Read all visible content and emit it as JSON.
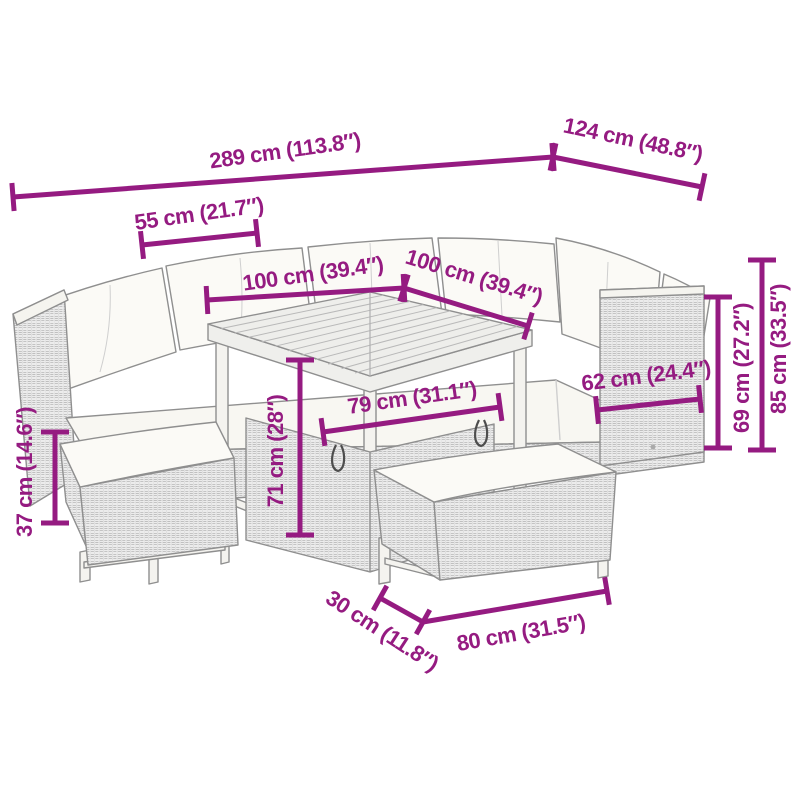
{
  "diagram": {
    "type": "furniture-dimension-diagram",
    "subject": "rattan-garden-lounge-set-with-table-and-benches",
    "accent_color": "#951b81",
    "palette": {
      "outline": "#8f8f8f",
      "wicker_fill": "#ececec",
      "wicker_weave": "#bfbfbf",
      "cushion_fill": "#fbfaf6",
      "background": "#ffffff"
    }
  },
  "dims": {
    "d289": {
      "label": "289 cm (113.8″)",
      "value_cm": 289,
      "value_in": 113.8
    },
    "d124": {
      "label": "124 cm (48.8″)",
      "value_cm": 124,
      "value_in": 48.8
    },
    "d55": {
      "label": "55 cm (21.7″)",
      "value_cm": 55,
      "value_in": 21.7
    },
    "d100a": {
      "label": "100 cm (39.4″)",
      "value_cm": 100,
      "value_in": 39.4
    },
    "d100b": {
      "label": "100 cm (39.4″)",
      "value_cm": 100,
      "value_in": 39.4
    },
    "d79": {
      "label": "79 cm (31.1″)",
      "value_cm": 79,
      "value_in": 31.1
    },
    "d71": {
      "label": "71 cm (28″)",
      "value_cm": 71,
      "value_in": 28
    },
    "d37": {
      "label": "37 cm (14.6″)",
      "value_cm": 37,
      "value_in": 14.6
    },
    "d30": {
      "label": "30 cm (11.8″)",
      "value_cm": 30,
      "value_in": 11.8
    },
    "d80": {
      "label": "80 cm (31.5″)",
      "value_cm": 80,
      "value_in": 31.5
    },
    "d62": {
      "label": "62 cm (24.4″)",
      "value_cm": 62,
      "value_in": 24.4
    },
    "d69": {
      "label": "69 cm (27.2″)",
      "value_cm": 69,
      "value_in": 27.2
    },
    "d85": {
      "label": "85 cm (33.5″)",
      "value_cm": 85,
      "value_in": 33.5
    }
  }
}
